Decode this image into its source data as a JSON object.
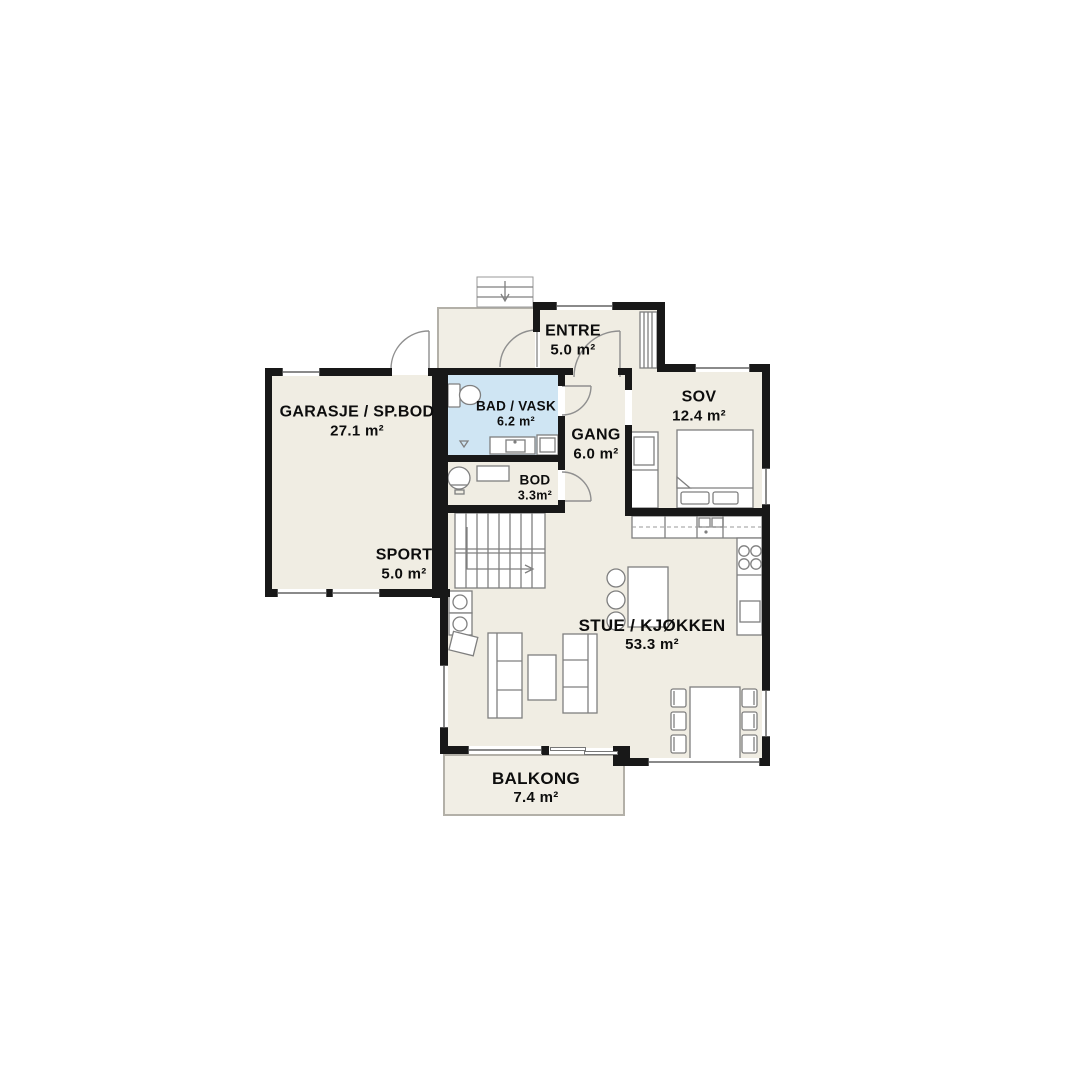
{
  "plan_title": "First floor plan",
  "rooms": [
    {
      "id": "garasje",
      "name": "GARASJE / SP.BOD",
      "area": "27.1 m²"
    },
    {
      "id": "sport",
      "name": "SPORT",
      "area": "5.0 m²"
    },
    {
      "id": "entre",
      "name": "ENTRE",
      "area": "5.0 m²"
    },
    {
      "id": "bad",
      "name": "BAD / VASK",
      "area": "6.2 m²"
    },
    {
      "id": "gang",
      "name": "GANG",
      "area": "6.0 m²"
    },
    {
      "id": "sov",
      "name": "SOV",
      "area": "12.4 m²"
    },
    {
      "id": "bod",
      "name": "BOD",
      "area": "3.3m²"
    },
    {
      "id": "stue",
      "name": "STUE / KJØKKEN",
      "area": "53.3 m²"
    },
    {
      "id": "balkong",
      "name": "BALKONG",
      "area": "7.4 m²"
    }
  ],
  "colors": {
    "background": "#ffffff",
    "floor": "#f0ede3",
    "wet_room_floor": "#cfe5f3",
    "wall": "#181818",
    "furniture_line": "#7f7f7f"
  }
}
